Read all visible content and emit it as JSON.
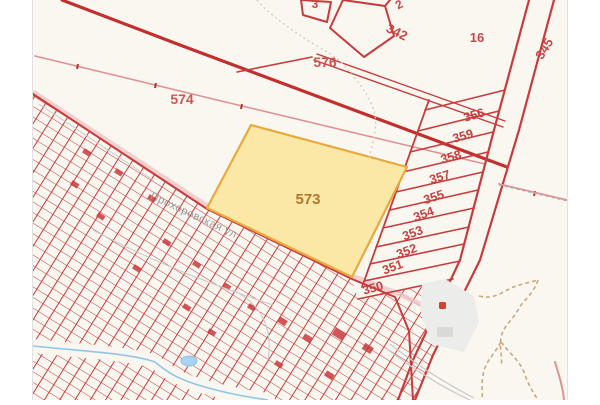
{
  "map": {
    "title": "cadastral-map-view",
    "selected_parcel": {
      "number": "573",
      "fill": "#fbe8a6",
      "border": "#e8a93e",
      "label_color": "#b5772e"
    },
    "street": {
      "name": "Прохоровская ул."
    },
    "labels": [
      {
        "kind": "parcel",
        "text": "574",
        "x": 149,
        "y": 104,
        "rot": 0,
        "size": 14,
        "color": "#cf5555",
        "weight": 600
      },
      {
        "kind": "parcel",
        "text": "576",
        "x": 292,
        "y": 67,
        "rot": 0,
        "size": 14,
        "color": "#cf5555",
        "weight": 600
      },
      {
        "kind": "parcel",
        "text": "573",
        "x": 275,
        "y": 204,
        "rot": 0,
        "size": 15,
        "color": "#b5772e",
        "weight": 600
      },
      {
        "kind": "parcel",
        "text": "342",
        "x": 362,
        "y": 36,
        "rot": 26,
        "size": 13,
        "color": "#c84747",
        "weight": 600
      },
      {
        "kind": "parcel",
        "text": "3",
        "x": 282,
        "y": 8,
        "rot": 0,
        "size": 12,
        "color": "#c84747",
        "weight": 600
      },
      {
        "kind": "parcel",
        "text": "2",
        "x": 368,
        "y": 8,
        "rot": -28,
        "size": 12,
        "color": "#c84747",
        "weight": 600
      },
      {
        "kind": "parcel",
        "text": "16",
        "x": 444,
        "y": 42,
        "rot": 0,
        "size": 13,
        "color": "#c84747",
        "weight": 600
      },
      {
        "kind": "parcel",
        "text": "345",
        "x": 515,
        "y": 51,
        "rot": -58,
        "size": 13,
        "color": "#c84747",
        "weight": 600
      },
      {
        "kind": "parcel",
        "text": "356",
        "x": 442,
        "y": 119,
        "rot": -16,
        "size": 12.5,
        "color": "#c84040",
        "weight": 600
      },
      {
        "kind": "parcel",
        "text": "359",
        "x": 431,
        "y": 140,
        "rot": -16,
        "size": 12.5,
        "color": "#c84040",
        "weight": 600
      },
      {
        "kind": "parcel",
        "text": "358",
        "x": 419,
        "y": 161,
        "rot": -16,
        "size": 12.5,
        "color": "#c84040",
        "weight": 600
      },
      {
        "kind": "parcel",
        "text": "357",
        "x": 408,
        "y": 181,
        "rot": -17,
        "size": 12.5,
        "color": "#c84040",
        "weight": 600
      },
      {
        "kind": "parcel",
        "text": "355",
        "x": 402,
        "y": 201,
        "rot": -18,
        "size": 12.5,
        "color": "#c84040",
        "weight": 600
      },
      {
        "kind": "parcel",
        "text": "354",
        "x": 392,
        "y": 218,
        "rot": -20,
        "size": 12.5,
        "color": "#c84040",
        "weight": 600
      },
      {
        "kind": "parcel",
        "text": "353",
        "x": 381,
        "y": 237,
        "rot": -20,
        "size": 12.5,
        "color": "#c84040",
        "weight": 600
      },
      {
        "kind": "parcel",
        "text": "352",
        "x": 375,
        "y": 255,
        "rot": -20,
        "size": 12.5,
        "color": "#c84040",
        "weight": 600
      },
      {
        "kind": "parcel",
        "text": "351",
        "x": 361,
        "y": 271,
        "rot": -20,
        "size": 12.5,
        "color": "#c84040",
        "weight": 600
      },
      {
        "kind": "parcel",
        "text": "350",
        "x": 341,
        "y": 292,
        "rot": -16,
        "size": 12.5,
        "color": "#c84040",
        "weight": 600
      },
      {
        "kind": "street",
        "text": "Прохоровская ул.",
        "x": 161,
        "y": 219,
        "rot": 25,
        "size": 11,
        "color": "#9a9a9a",
        "weight": 400
      }
    ],
    "colors": {
      "mapbg": "#faf7f1",
      "frame": "#e2e2e2",
      "red": "#c83a3c",
      "reddark": "#c22f2f",
      "pink": "#dd9395",
      "pinkband": "#eec2c2",
      "gray": "#c7c7c7",
      "graydash": "#a9a9a9",
      "contour": "#d6cbb6",
      "tan": "#c9a87d",
      "water": "#8fc6e8",
      "waterfill": "#a9d3ec",
      "quarry": "#ececea",
      "graybldg": "#d9d9d7",
      "marker": "#d0452f"
    }
  }
}
